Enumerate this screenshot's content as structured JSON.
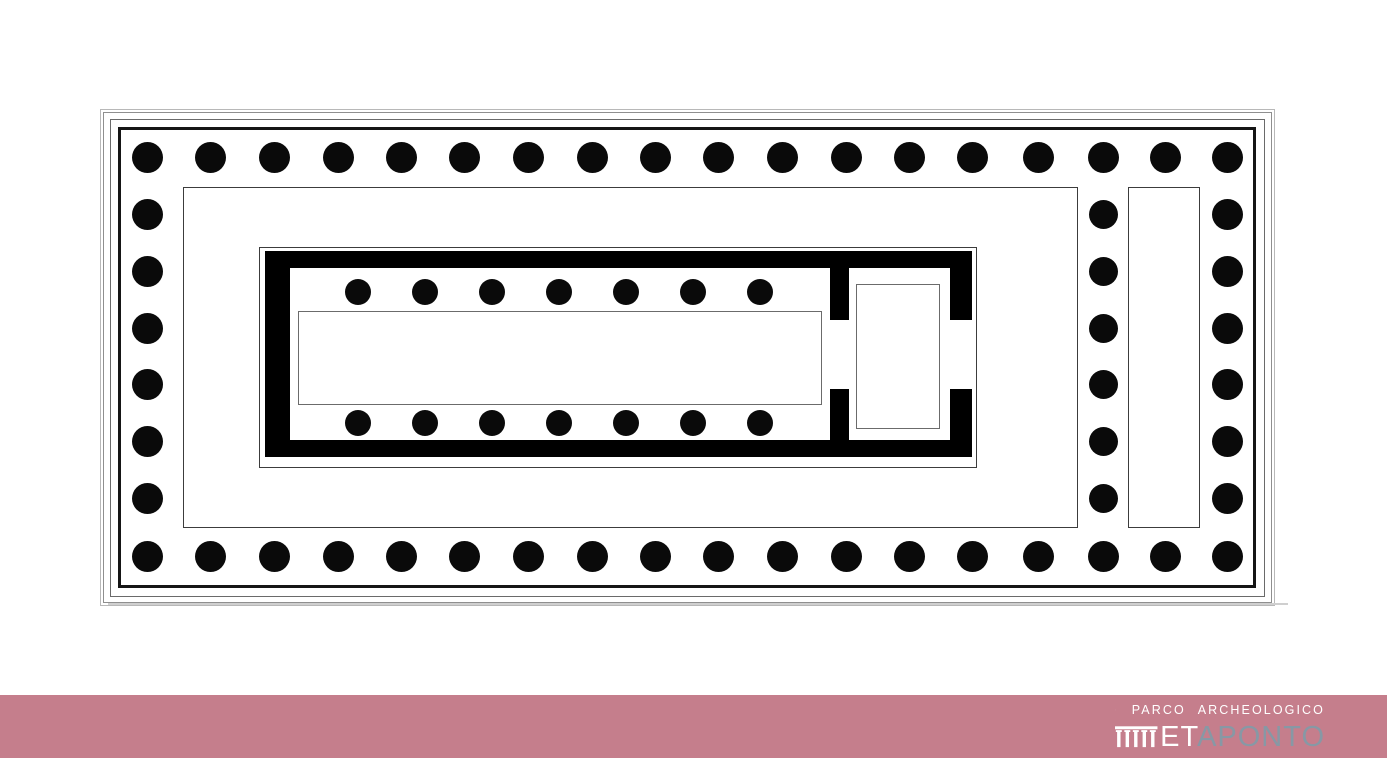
{
  "footer": {
    "band_color": "#c57e8c",
    "parco_text": "PARCO ARCHEOLOGICO",
    "met_white": "ET",
    "met_gray": "APONTO",
    "met_gray_color": "#8798a5"
  },
  "plan": {
    "background_color": "#ffffff",
    "wall_color": "#000000",
    "column_color": "#0a0a0a",
    "frames": [
      {
        "name": "crepidoma-step-outer",
        "x": 100,
        "y": 109,
        "w": 1175,
        "h": 497,
        "color": "#b8b8b8",
        "t": 1
      },
      {
        "name": "crepidoma-step-2",
        "x": 103,
        "y": 112,
        "w": 1169,
        "h": 491,
        "color": "#8f8f8f",
        "t": 1.5
      },
      {
        "name": "crepidoma-step-3",
        "x": 110,
        "y": 119,
        "w": 1155,
        "h": 478,
        "color": "#6a6a6a",
        "t": 1.5
      },
      {
        "name": "stylobate-edge",
        "x": 118,
        "y": 127,
        "w": 1138,
        "h": 461,
        "color": "#151515",
        "t": 3
      }
    ],
    "outline_rects": [
      {
        "name": "inner-platform",
        "x": 183,
        "y": 187,
        "w": 895,
        "h": 341,
        "color": "#3c3c3c",
        "t": 1.5
      },
      {
        "name": "right-foundation",
        "x": 1128,
        "y": 187,
        "w": 72,
        "h": 341,
        "color": "#3c3c3c",
        "t": 1.5
      },
      {
        "name": "cella-outline",
        "x": 259,
        "y": 247,
        "w": 718,
        "h": 221,
        "color": "#3c3c3c",
        "t": 1.5
      },
      {
        "name": "naos-floor",
        "x": 298,
        "y": 311,
        "w": 524,
        "h": 94,
        "color": "#6b6b6b",
        "t": 1.2
      },
      {
        "name": "adyton-base",
        "x": 856,
        "y": 284,
        "w": 84,
        "h": 145,
        "color": "#6b6b6b",
        "t": 1.2
      }
    ],
    "walls": [
      {
        "name": "cella-wall-north",
        "x": 265,
        "y": 251,
        "w": 707,
        "h": 17
      },
      {
        "name": "cella-wall-south",
        "x": 265,
        "y": 440,
        "w": 707,
        "h": 17
      },
      {
        "name": "cella-wall-west",
        "x": 265,
        "y": 251,
        "w": 25,
        "h": 206
      },
      {
        "name": "cella-wall-east-upper",
        "x": 950,
        "y": 268,
        "w": 22,
        "h": 52
      },
      {
        "name": "cella-wall-east-lower",
        "x": 950,
        "y": 389,
        "w": 22,
        "h": 51
      },
      {
        "name": "adyton-wall-upper",
        "x": 830,
        "y": 268,
        "w": 19,
        "h": 52
      },
      {
        "name": "adyton-wall-lower",
        "x": 830,
        "y": 389,
        "w": 19,
        "h": 51
      }
    ],
    "colonnades": [
      {
        "name": "peristyle-north",
        "d": 31,
        "y": 157,
        "xs": [
          147,
          210,
          274,
          338,
          401,
          464,
          528,
          592,
          655,
          718,
          782,
          846,
          909,
          972,
          1038,
          1103,
          1165,
          1227
        ]
      },
      {
        "name": "peristyle-south",
        "d": 31,
        "y": 556,
        "xs": [
          147,
          210,
          274,
          338,
          401,
          464,
          528,
          592,
          655,
          718,
          782,
          846,
          909,
          972,
          1038,
          1103,
          1165,
          1227
        ]
      },
      {
        "name": "peristyle-west",
        "d": 31,
        "x": 147,
        "ys": [
          214,
          271,
          328,
          384,
          441,
          498
        ]
      },
      {
        "name": "peristyle-east",
        "d": 31,
        "x": 1227,
        "ys": [
          214,
          271,
          328,
          384,
          441,
          498
        ]
      },
      {
        "name": "front-inner-row",
        "d": 29,
        "x": 1103,
        "ys": [
          214,
          271,
          328,
          384,
          441,
          498
        ]
      },
      {
        "name": "cella-interior-north",
        "d": 26,
        "y": 292,
        "xs": [
          358,
          425,
          492,
          559,
          626,
          693,
          760
        ]
      },
      {
        "name": "cella-interior-south",
        "d": 26,
        "y": 423,
        "xs": [
          358,
          425,
          492,
          559,
          626,
          693,
          760
        ]
      }
    ],
    "scan_shadow": {
      "x": 108,
      "y": 603,
      "w": 1180,
      "h": 2,
      "color": "#cfcfcf"
    }
  }
}
